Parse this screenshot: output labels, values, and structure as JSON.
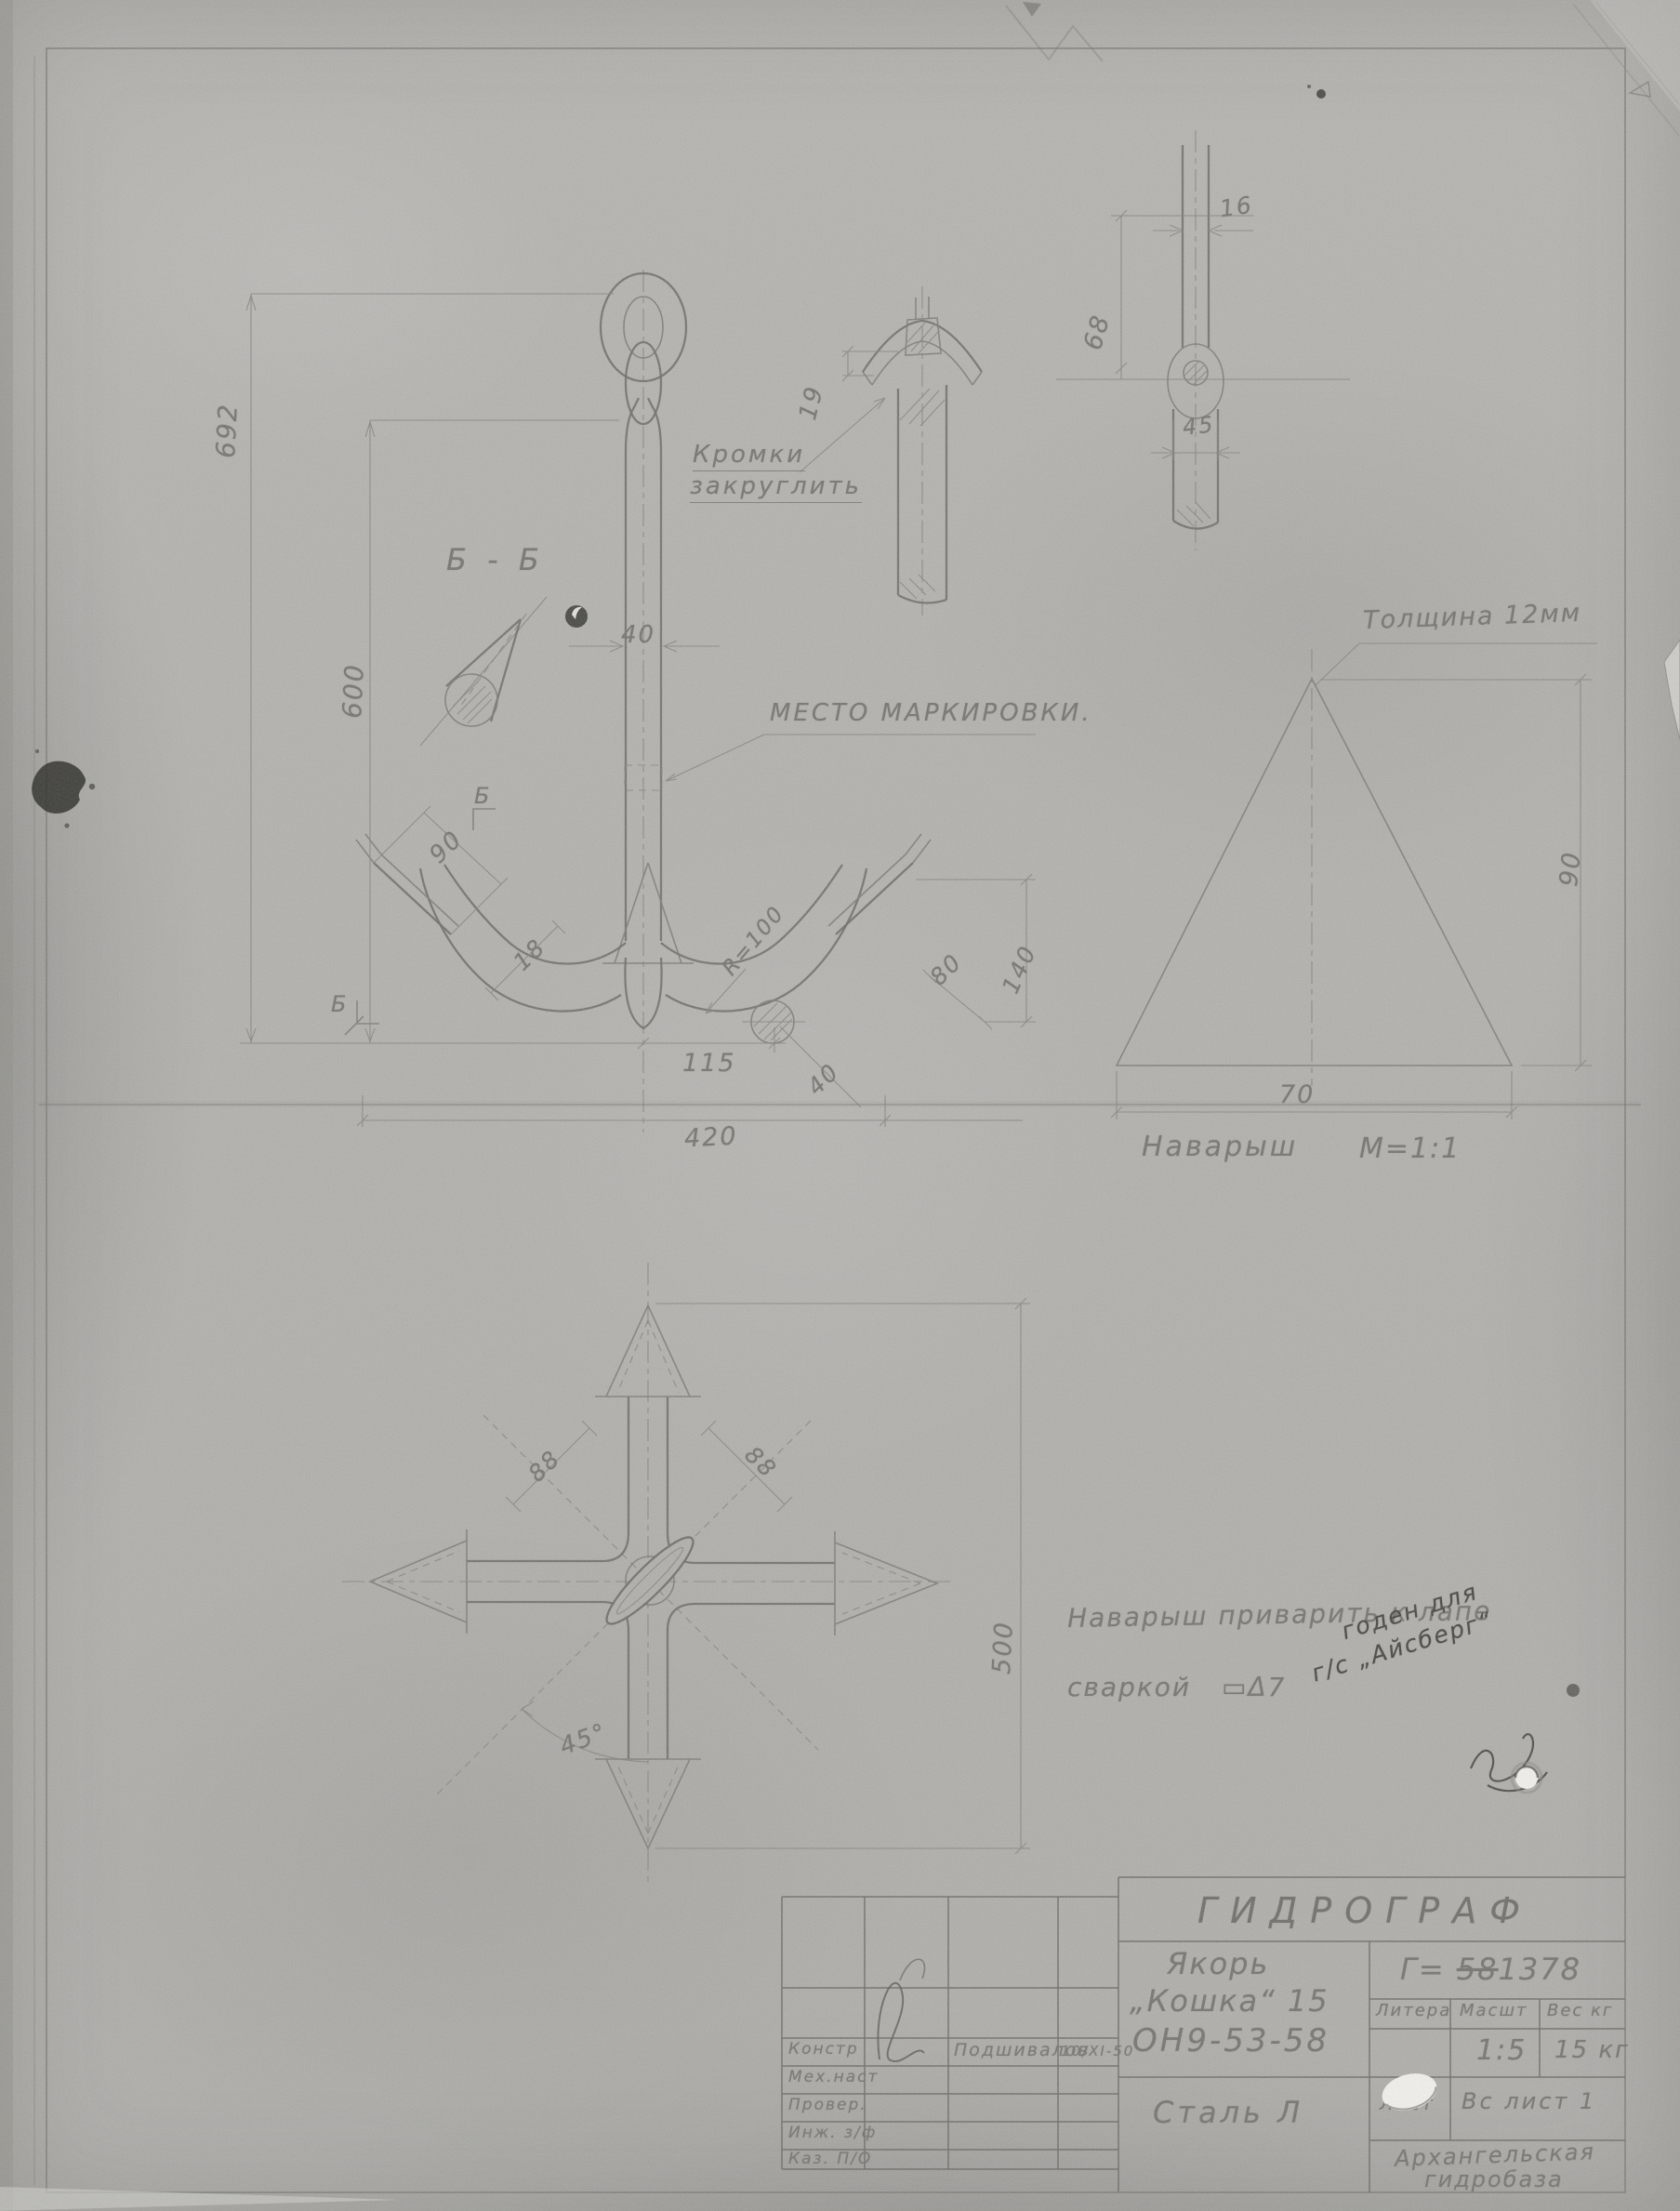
{
  "colors": {
    "paper": "#b3b2ae",
    "pencil": "#78776f",
    "ink": "#45453f"
  },
  "front_view": {
    "section_label": "Б - Б",
    "note_edges_line1": "Кромки",
    "note_edges_line2": "закруглить",
    "note_marking": "МЕСТО МАРКИРОВКИ.",
    "dim_overall": "692",
    "dim_shank": "600",
    "dim_width": "40",
    "dim_blade": "90",
    "dim_thickness": "18",
    "dim_115": "115",
    "dim_420": "420",
    "dim_40_diag": "40",
    "dim_radius": "R=100",
    "dim_80": "80",
    "dim_140": "140",
    "mark_b_top": "Б",
    "mark_b_bottom": "Б"
  },
  "arm_section": {
    "dim_19": "19"
  },
  "shank_side_view": {
    "dim_16": "16",
    "dim_68": "68",
    "dim_45": "45"
  },
  "pad_detail": {
    "note_thickness": "Толщина 12мм",
    "dim_70": "70",
    "dim_90": "90",
    "caption": "Наварыш",
    "scale": "М=1:1"
  },
  "plan_view": {
    "dim_88_left": "88",
    "dim_88_right": "88",
    "dim_angle": "45°",
    "dim_500": "500"
  },
  "weld_note": {
    "line1": "Наварыш приварить к лапе",
    "line2": "сваркой",
    "symbol": "▭Δ7"
  },
  "stamp_note": {
    "line1": "годен для",
    "line2": "г/с „Айсберг“"
  },
  "title_block": {
    "org": "ГИДРОГРАФ",
    "item_line1": "Якорь",
    "item_line2": "„Кошка“ 15",
    "item_code": "ОН9-53-58",
    "material": "Сталь Л",
    "doc_prefix": "Г=",
    "doc_struck": "58",
    "doc_number": "1378",
    "col_litera": "Литера",
    "col_scale": "Масшт",
    "col_weight": "Вес кг",
    "scale_value": "1:5",
    "weight_value": "15 кг",
    "sheet_label": "Лист",
    "sheets_label": "Вс лист 1",
    "org2_line1": "Архангельская",
    "org2_line2": "гидробаза"
  },
  "sig_table": {
    "rows": [
      {
        "label": "Констр",
        "name": "Подшивалов",
        "date": "10/XI-50"
      },
      {
        "label": "Мех.наст",
        "name": "",
        "date": ""
      },
      {
        "label": "Провер.",
        "name": "",
        "date": ""
      },
      {
        "label": "Инж. з/ф",
        "name": "",
        "date": ""
      },
      {
        "label": "Каз. П/О",
        "name": "",
        "date": ""
      }
    ]
  }
}
